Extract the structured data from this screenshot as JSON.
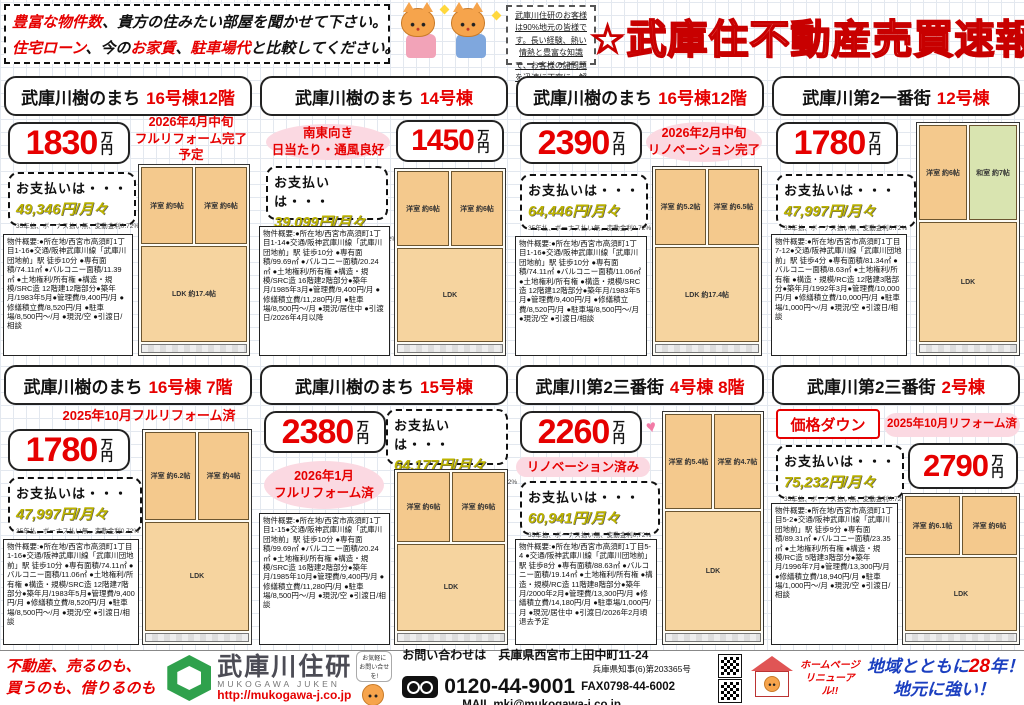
{
  "header": {
    "promo1_red": "豊富な物件数",
    "promo1_rest": "、貴方の住みたい部屋を聞かせて下さい。",
    "promo2_red1": "住宅ローン",
    "promo2_mid1": "、今の",
    "promo2_red2": "お家賃",
    "promo2_mid2": "、",
    "promo2_red3": "駐車場代",
    "promo2_rest": "と比較してください。",
    "notice": "武庫川住研のお客様は90%地元の皆様です。長い経験、熱い情熱と豊富な知識で、お客様の諸問題を迅速に丁寧に、解決いたします！！",
    "title": "☆武庫住不動産売買速報"
  },
  "cards": [
    {
      "title_black": "武庫川樹のまち",
      "title_red": "16号棟12階",
      "price": "1830",
      "price_unit": "万円",
      "promo": "2026年4月中旬\nフルリフォーム完了予定",
      "payment_label": "お支払いは・・・",
      "payment_amount": "49,346円/月々",
      "payment_note": "35年払、ボーナス払い無、変動金利0.72%",
      "overview": "物件概要:●所在地/西宮市高須町1丁目1-16●交通/阪神武庫川線「武庫川団地前」駅 徒歩10分 ●専有面積/74.11㎡ ●バルコニー面積/11.39㎡ ●土地権利/所有権 ●構造・規模/SRC造 12階建12階部分●築年月/1983年5月●管理費/9,400円/月 ●修繕積立費/8,520円/月 ●駐車場/8,500円～/月 ●現況/空 ●引渡日/相談",
      "rooms": [
        "洋室 約5帖",
        "洋室 約6帖",
        "LDK 約17.4帖"
      ]
    },
    {
      "title_black": "武庫川樹のまち",
      "title_red": "14号棟",
      "price": "1450",
      "price_unit": "万円",
      "promo": "南東向き\n日当たり・通風良好",
      "payment_label": "お支払いは・・・",
      "payment_amount": "39,099円/月々",
      "payment_note": "35年払、ボーナス払い無、変動金利0.72%",
      "overview": "物件概要:●所在地/西宮市高須町1丁目1-14●交通/阪神武庫川線「武庫川団地前」駅 徒歩10分 ●専有面積/99.69㎡ ●バルコニー面積/20.24㎡ ●土地権利/所有権 ●構造・規模/SRC造 16階建2階部分●築年月/1985年3月●管理費/9,400円/月 ●修繕積立費/11,280円/月 ●駐車場/8,500円～/月 ●現況/居住中 ●引渡日/2026年4月以降",
      "rooms": [
        "洋室 約6帖",
        "洋室 約6帖",
        "LDK"
      ]
    },
    {
      "title_black": "武庫川樹のまち",
      "title_red": "16号棟12階",
      "price": "2390",
      "price_unit": "万円",
      "promo": "2026年2月中旬\nリノベーション完了",
      "payment_label": "お支払いは・・・",
      "payment_amount": "64,446円/月々",
      "payment_note": "35年払、ボーナス払い無、変動金利0.72%",
      "overview": "物件概要:●所在地/西宮市高須町1丁目1-16●交通/阪神武庫川線「武庫川団地前」駅 徒歩10分 ●専有面積/74.11㎡ ●バルコニー面積/11.06㎡ ●土地権利/所有権 ●構造・規模/SRC造 12階建12階部分●築年月/1983年5月●管理費/9,400円/月 ●修繕積立費/8,520円/月 ●駐車場/8,500円～/月 ●現況/空 ●引渡日/相談",
      "rooms": [
        "洋室 約5.2帖",
        "洋室 約6.5帖",
        "LDK 約17.4帖"
      ]
    },
    {
      "title_black": "武庫川第2一番街",
      "title_red": "12号棟",
      "price": "1780",
      "price_unit": "万円",
      "payment_label": "お支払いは・・・",
      "payment_amount": "47,997円/月々",
      "payment_note": "35年払、ボーナス払い無、変動金利0.72%",
      "overview": "物件概要:●所在地/西宮市高須町1丁目7-12●交通/阪神武庫川線「武庫川団地前」駅 徒歩4分 ●専有面積/81.34㎡ ●バルコニー面積/8.63㎡ ●土地権利/所有権 ●構造・規模/RC造 12階建3階部分●築年月/1992年3月●管理費/10,000円/月 ●修繕積立費/10,000円/月 ●駐車場/1,000円～/月 ●現況/空 ●引渡日/相談",
      "rooms": [
        "洋室 約6帖",
        "和室 約7帖",
        "LDK"
      ]
    },
    {
      "title_black": "武庫川樹のまち",
      "title_red": "16号棟 7階",
      "price": "1780",
      "price_unit": "万円",
      "promo": "2025年10月フルリフォーム済",
      "payment_label": "お支払いは・・・",
      "payment_amount": "47,997円/月々",
      "payment_note": "35年払、ボーナス払い無、変動金利0.72%",
      "overview": "物件概要:●所在地/西宮市高須町1丁目1-16●交通/阪神武庫川線「武庫川団地前」駅 徒歩10分 ●専有面積/74.11㎡ ●バルコニー面積/11.06㎡ ●土地権利/所有権 ●構造・規模/SRC造 12階建7階部分●築年月/1983年5月●管理費/9,400円/月 ●修繕積立費/8,520円/月 ●駐車場/8,500円～/月 ●現況/空 ●引渡日/相談",
      "rooms": [
        "洋室 約6.2帖",
        "洋室 約4帖",
        "LDK"
      ]
    },
    {
      "title_black": "武庫川樹のまち",
      "title_red": "15号棟",
      "price": "2380",
      "price_unit": "万円",
      "promo": "2026年1月\nフルリフォーム済",
      "payment_label": "お支払いは・・・",
      "payment_amount": "64,177円/月々",
      "payment_note": "35年払、ボーナス払い無、変動金利0.72%",
      "overview": "物件概要:●所在地/西宮市高須町1丁目1-15●交通/阪神武庫川線「武庫川団地前」駅 徒歩10分 ●専有面積/99.69㎡ ●バルコニー面積/20.24㎡ ●土地権利/所有権 ●構造・規模/SRC造 16階建2階部分●築年月/1985年10月●管理費/9,400円/月 ●修繕積立費/11,280円/月 ●駐車場/8,500円～/月 ●現況/空 ●引渡日/相談",
      "rooms": [
        "洋室 約6帖",
        "洋室 約6帖",
        "LDK"
      ]
    },
    {
      "title_black": "武庫川第2三番街",
      "title_red": "4号棟 8階",
      "price": "2260",
      "price_unit": "万円",
      "promo": "リノベーション済み",
      "hearts": "♥ ♥",
      "payment_label": "お支払いは・・・",
      "payment_amount": "60,941円/月々",
      "payment_note": "35年払、ボーナス払い無、変動金利0.72%",
      "overview": "物件概要:●所在地/西宮市高須町1丁目5-4 ●交通/阪神武庫川線「武庫川団地前」駅 徒歩8分 ●専有面積/88.63㎡ ●バルコニー面積/19.14㎡ ●土地権利/所有権 ●構造・規模/RC造 11階建8階部分●築年月/2000年2月●管理費/13,300円/月 ●修繕積立費/14,180円/月 ●駐車場/1,000円/月 ●現況/居住中 ●引渡日/2026年2月頃退去予定",
      "rooms": [
        "洋室 約5.4帖",
        "洋室 約4.7帖",
        "LDK"
      ]
    },
    {
      "title_black": "武庫川第2三番街",
      "title_red": "2号棟",
      "price": "2790",
      "price_unit": "万円",
      "badge": "価格ダウン",
      "promo": "2025年10月リフォーム済",
      "payment_label": "お支払いは・・・",
      "payment_amount": "75,232円/月々",
      "payment_note": "35年払、ボーナス払い無、変動金利0.72%",
      "overview": "物件概要:●所在地/西宮市高須町1丁目5-2●交通/阪神武庫川線「武庫川団地前」駅 徒歩9分 ●専有面積/89.31㎡ ●バルコニー面積/23.35㎡ ●土地権利/所有権 ●構造・規模/RC造 5階建3階部分●築年月/1996年7月●管理費/13,300円/月 ●修繕積立費/18,940円/月 ●駐車場/1,000円～/月 ●現況/空 ●引渡日/相談",
      "rooms": [
        "洋室 約6.1帖",
        "洋室 約6帖",
        "LDK"
      ]
    }
  ],
  "footer": {
    "left1": "不動産、売るのも、",
    "left2": "買うのも、借りるのも",
    "company": "武庫川住研",
    "company_en": "MUKOGAWA JUKEN",
    "url": "http://mukogawa-j.co.jp",
    "bubble": "お気軽に お問い合せを!",
    "contact_label": "お問い合わせは",
    "address": "兵庫県西宮市上田中町11-24",
    "license": "兵庫県知事(6)第203365号",
    "tel": "0120-44-9001",
    "fax": "FAX0798-44-6002",
    "mail": "MAIL mkj@mukogawa-j.co.jp",
    "hp1": "ホームページ",
    "hp2": "リニューアル!!",
    "slogan1_pre": "地域とともに",
    "slogan1_num": "28",
    "slogan1_post": "年！",
    "slogan2": "地元に強い！"
  }
}
